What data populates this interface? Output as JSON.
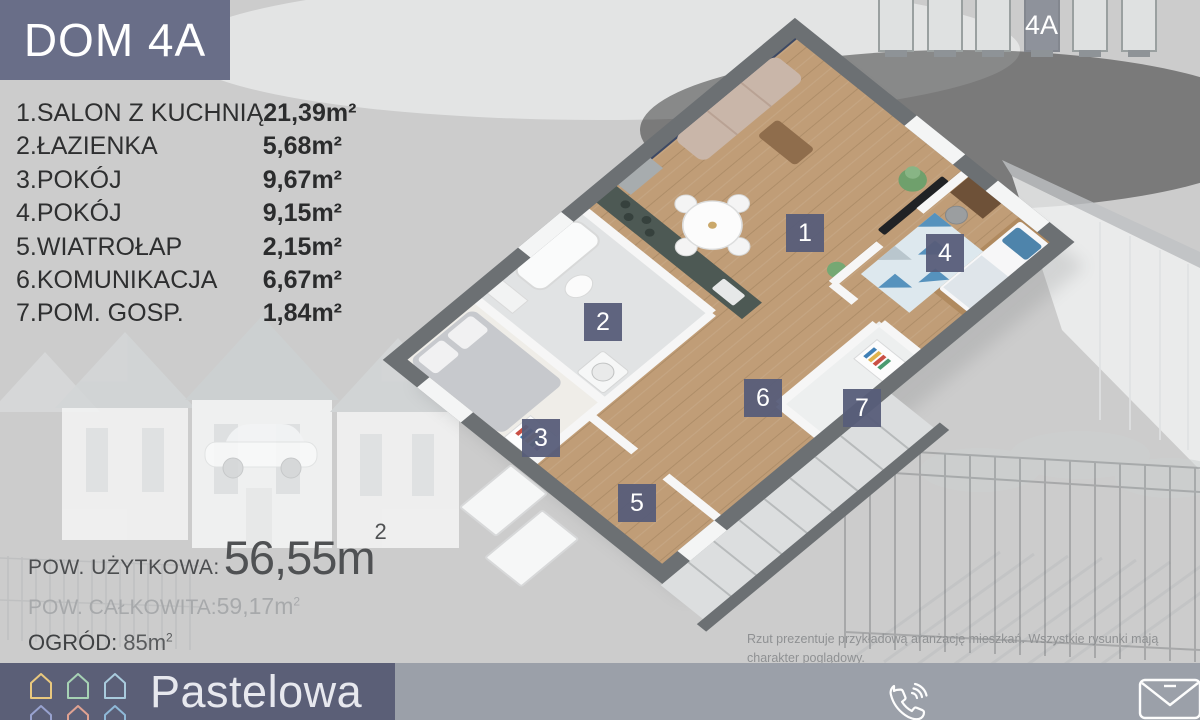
{
  "header": {
    "title": "DOM 4A"
  },
  "unit_selector": {
    "selected_label": "4A"
  },
  "rooms": [
    {
      "label": "1.SALON Z KUCHNIĄ",
      "area": "21,39m²"
    },
    {
      "label": "2.ŁAZIENKA",
      "area": "5,68m²"
    },
    {
      "label": "3.POKÓJ",
      "area": "9,67m²"
    },
    {
      "label": "4.POKÓJ",
      "area": "9,15m²"
    },
    {
      "label": "5.WIATROŁAP",
      "area": "2,15m²"
    },
    {
      "label": "6.KOMUNIKACJA",
      "area": "6,67m²"
    },
    {
      "label": "7.POM. GOSP.",
      "area": "1,84m²"
    }
  ],
  "plan": {
    "badges": [
      "1",
      "2",
      "3",
      "4",
      "5",
      "6",
      "7"
    ]
  },
  "stats": {
    "usable_label": "POW. UŻYTKOWA:",
    "usable_value": "56,55m",
    "usable_sup": "2",
    "total_label": "POW. CAŁKOWITA:",
    "total_value": "59,17m",
    "total_sup": "2",
    "garden_label": "OGRÓD:",
    "garden_value": "85m",
    "garden_sup": "2"
  },
  "disclaimer": {
    "line1": "Rzut prezentuje przykładową aranżację mieszkań. Wszystkie rysunki mają charakter poglądowy.",
    "line2": "Niniejszy materiał nie stanowi oferty w rozumieniu przepisów kodeksu cywilnego."
  },
  "footer": {
    "brand": "Pastelowa",
    "logo_colors": [
      "#e9c87e",
      "#a6d2b4",
      "#a9cbdd",
      "#98a2cf",
      "#e0a292",
      "#8fb9d8"
    ],
    "icons": {
      "phone": "phone-icon",
      "mail": "mail-icon",
      "website": "website-icon"
    }
  },
  "colors": {
    "accent_slate": "#696e88",
    "badge": "#575d79",
    "footer_dark": "#5b5f77",
    "footer_light": "#9ba0a9",
    "navy_wall": "#3d4964",
    "wood": "#c09d77"
  }
}
